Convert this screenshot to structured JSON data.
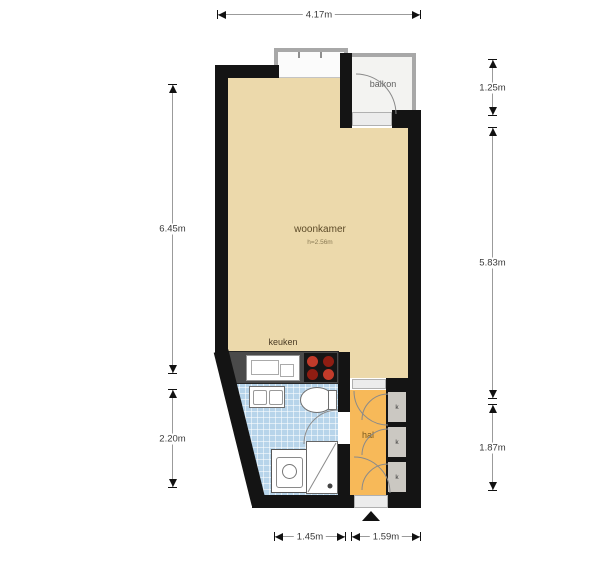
{
  "plan": {
    "rooms": {
      "woonkamer": {
        "label": "woonkamer",
        "height_note": "h=2.56m"
      },
      "balkon": {
        "label": "balkon"
      },
      "keuken": {
        "label": "keuken"
      },
      "hal": {
        "label": "hal"
      }
    },
    "closets": [
      "k",
      "k",
      "k"
    ],
    "dimensions": {
      "top": "4.17m",
      "right_balcony": "1.25m",
      "right_main": "5.83m",
      "right_lower": "1.87m",
      "left_upper": "6.45m",
      "left_lower": "2.20m",
      "bottom_left": "1.45m",
      "bottom_right": "1.59m"
    },
    "colors": {
      "wall": "#141414",
      "woonkamer_floor": "#ecd9ab",
      "balkon_floor": "#f3f3f1",
      "bathroom_floor": "#b7d4ea",
      "hal_floor": "#f7b959",
      "closet_floor": "#cbc8c2",
      "counter": "#4a4a4a",
      "burner_hot": "#c23b2a",
      "burner_dark": "#8f1d12"
    }
  }
}
